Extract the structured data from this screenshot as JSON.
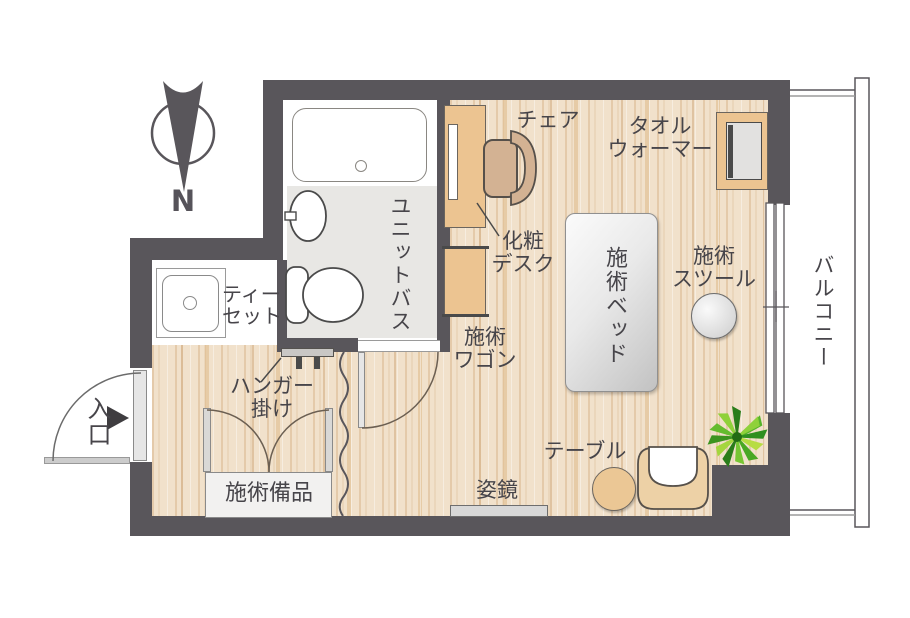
{
  "compass": {
    "label": "N"
  },
  "rooms": {
    "entrance": "入口",
    "unit_bath": "ユニットバス",
    "balcony": "バルコニー"
  },
  "items": {
    "chair": "チェア",
    "towel_warmer": [
      "タオル",
      "ウォーマー"
    ],
    "makeup_desk": [
      "化粧",
      "デスク"
    ],
    "treatment_bed": "施術ベッド",
    "treatment_stool": [
      "施術",
      "スツール"
    ],
    "treatment_wagon": [
      "施術",
      "ワゴン"
    ],
    "tea_set": [
      "ティー",
      "セット"
    ],
    "hanger_rack": [
      "ハンガー",
      "掛け"
    ],
    "treatment_equipment": "施術備品",
    "mirror": "姿鏡",
    "table": "テーブル"
  },
  "colors": {
    "wall": "#59565b",
    "wood_floor_base": "#f1e1cb",
    "bath_floor": "#e8e7e4",
    "furniture_wood": "#ecc491",
    "bed_gray": "#d9d9d9",
    "text": "#47454a",
    "plant_green": "#55b32a"
  }
}
